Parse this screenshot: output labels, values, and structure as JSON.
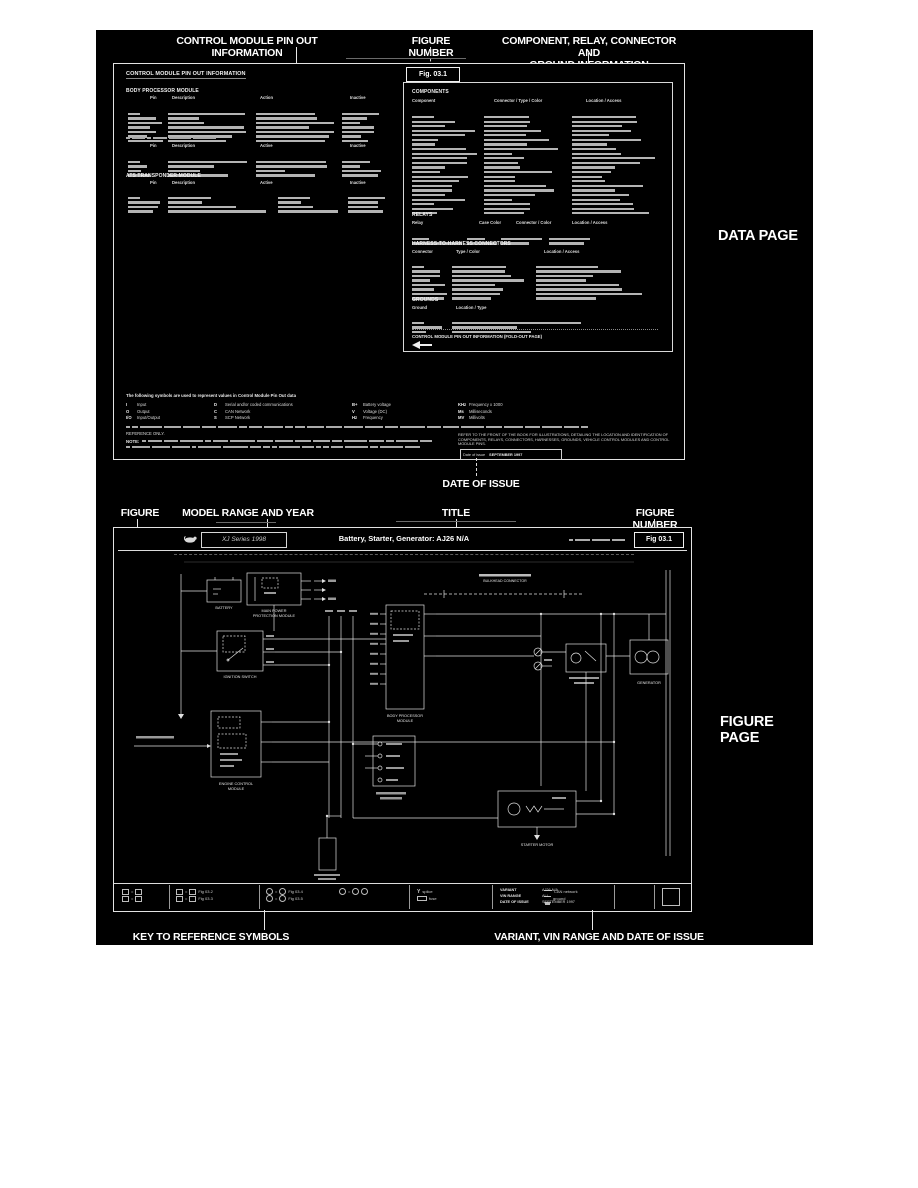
{
  "annotations": {
    "control_module_label": "CONTROL MODULE PIN OUT INFORMATION",
    "figure_number_label_top": "FIGURE NUMBER",
    "component_label_line1": "COMPONENT, RELAY, CONNECTOR AND",
    "component_label_line2": "GROUND INFORMATION",
    "data_page_label": "DATA PAGE",
    "date_of_issue_label": "DATE OF ISSUE",
    "figure_label": "FIGURE",
    "model_range_label": "MODEL RANGE AND YEAR",
    "title_label": "TITLE",
    "figure_number_label_bottom": "FIGURE NUMBER",
    "figure_page_label": "FIGURE PAGE",
    "key_symbols_label": "KEY TO REFERENCE SYMBOLS",
    "variant_label": "VARIANT, VIN RANGE AND DATE OF ISSUE"
  },
  "data_page": {
    "title": "CONTROL MODULE PIN OUT INFORMATION",
    "figure_number": "Fig. 03.1",
    "bpm": {
      "title": "BODY PROCESSOR MODULE",
      "h": [
        "Pin",
        "Description",
        "Action",
        "Inactive"
      ]
    },
    "module2": {
      "h": [
        "Pin",
        "Description",
        "Active",
        "Inactive"
      ]
    },
    "ats": {
      "title": "ATS TRANSPONDER MODULE",
      "h": [
        "Pin",
        "Description",
        "Active",
        "Inactive"
      ]
    },
    "components": {
      "title": "COMPONENTS",
      "h": [
        "Component",
        "Connector / Type / Color",
        "Location / Access"
      ]
    },
    "relays": {
      "title": "RELAYS",
      "h": [
        "Relay",
        "Case Color",
        "Connector / Color",
        "Location / Access"
      ]
    },
    "h2h": {
      "title": "HARNESS-TO-HARNESS CONNECTORS",
      "h": [
        "Connector",
        "Type / Color",
        "Location / Access"
      ]
    },
    "grounds": {
      "title": "GROUNDS",
      "h": [
        "Ground",
        "Location / Type"
      ]
    },
    "foldout": "CONTROL MODULE PIN OUT INFORMATION (FOLD-OUT PAGE)",
    "legend_intro": "The following symbols are used to represent values in Control Module Pin Out data",
    "legend": [
      {
        "code": "I",
        "meaning": "Input"
      },
      {
        "code": "O",
        "meaning": "Output"
      },
      {
        "code": "I/O",
        "meaning": "Input/Output"
      },
      {
        "code": "D",
        "meaning": "Serial and/or coded communications"
      },
      {
        "code": "C",
        "meaning": "CAN Network"
      },
      {
        "code": "S",
        "meaning": "SCP Network"
      },
      {
        "code": "B+",
        "meaning": "Battery voltage"
      },
      {
        "code": "V",
        "meaning": "Voltage (DC)"
      },
      {
        "code": "Hz",
        "meaning": "Frequency"
      },
      {
        "code": "KHz",
        "meaning": "Frequency x 1000"
      },
      {
        "code": "Ms",
        "meaning": "Milliseconds"
      },
      {
        "code": "MV",
        "meaning": "Millivolts"
      }
    ],
    "reference_only": "REFERENCE ONLY.",
    "note_label": "NOTE:",
    "refer_text": "REFER TO THE FRONT OF THE BOOK FOR ILLUSTRATIONS, DETAILING THE LOCATION AND IDENTIFICATION OF COMPONENTS, RELAYS, CONNECTORS, HARNESSES, GROUNDS, VEHICLE CONTROL MODULES AND CONTROL MODULE PINS.",
    "date_box": {
      "label": "Date of issue",
      "value": "SEPTEMBER 1997"
    }
  },
  "figure_page": {
    "model_range": "XJ Series 1998",
    "title": "Battery, Starter, Generator: AJ26 N/A",
    "figure_number": "Fig 03.1",
    "labels": {
      "battery": "BATTERY",
      "power_module_1": "MAIN POWER",
      "power_module_2": "PROTECTION MODULE",
      "ignition": "IGNITION SWITCH",
      "ecm_1": "ENGINE CONTROL",
      "ecm_2": "MODULE",
      "bpm_1": "BODY PROCESSOR",
      "bpm_2": "MODULE",
      "bulkhead": "BULKHEAD CONNECTOR",
      "starter": "STARTER MOTOR",
      "generator": "GENERATOR"
    },
    "key": {
      "refs": [
        "Fig 03.2",
        "Fig 03.3",
        "Fig 03.4",
        "Fig 03.5"
      ],
      "syms": [
        "splice",
        "fuse",
        "CAN network",
        "ground"
      ]
    },
    "variant": [
      {
        "label": "VARIANT",
        "value": "AJ26 N/A"
      },
      {
        "label": "VIN RANGE",
        "value": "ALL"
      },
      {
        "label": "DATE OF ISSUE",
        "value": "SEPTEMBER 1997"
      }
    ]
  }
}
